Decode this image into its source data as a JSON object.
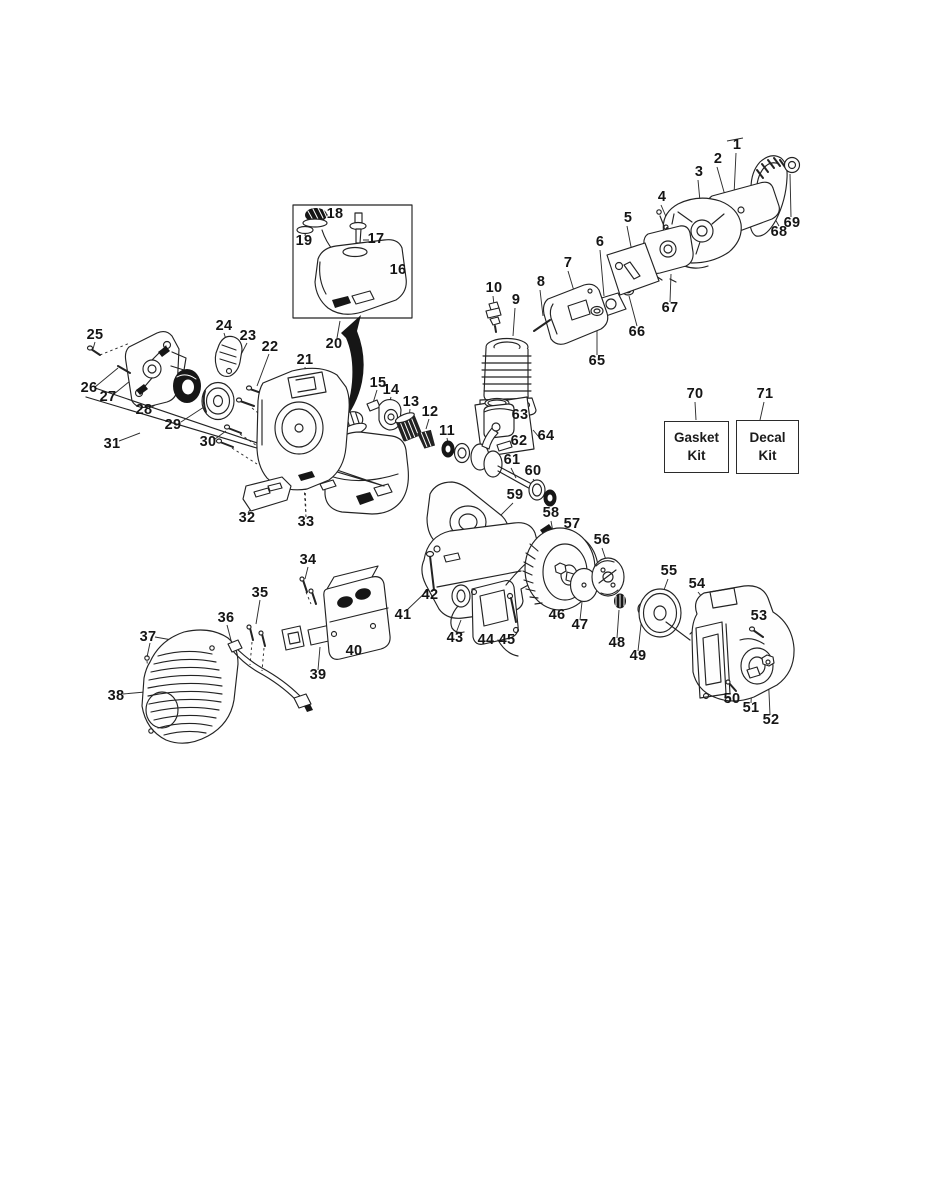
{
  "page": {
    "background": "#ffffff",
    "ink": "#232323",
    "kind": "exploded parts diagram"
  },
  "diagram": {
    "part_labels": [
      {
        "n": "1",
        "x": 737,
        "y": 146
      },
      {
        "n": "2",
        "x": 718,
        "y": 160
      },
      {
        "n": "3",
        "x": 699,
        "y": 173
      },
      {
        "n": "4",
        "x": 662,
        "y": 198
      },
      {
        "n": "5",
        "x": 628,
        "y": 219
      },
      {
        "n": "6",
        "x": 600,
        "y": 243
      },
      {
        "n": "7",
        "x": 568,
        "y": 264
      },
      {
        "n": "8",
        "x": 541,
        "y": 283
      },
      {
        "n": "9",
        "x": 516,
        "y": 301
      },
      {
        "n": "10",
        "x": 494,
        "y": 289
      },
      {
        "n": "11",
        "x": 447,
        "y": 432
      },
      {
        "n": "12",
        "x": 430,
        "y": 413
      },
      {
        "n": "13",
        "x": 411,
        "y": 403
      },
      {
        "n": "14",
        "x": 391,
        "y": 391
      },
      {
        "n": "15",
        "x": 378,
        "y": 384
      },
      {
        "n": "16",
        "x": 398,
        "y": 271
      },
      {
        "n": "17",
        "x": 376,
        "y": 240
      },
      {
        "n": "18",
        "x": 335,
        "y": 215
      },
      {
        "n": "19",
        "x": 304,
        "y": 242
      },
      {
        "n": "20",
        "x": 334,
        "y": 345
      },
      {
        "n": "21",
        "x": 305,
        "y": 361
      },
      {
        "n": "22",
        "x": 270,
        "y": 348
      },
      {
        "n": "23",
        "x": 248,
        "y": 337
      },
      {
        "n": "24",
        "x": 224,
        "y": 327
      },
      {
        "n": "25",
        "x": 95,
        "y": 336
      },
      {
        "n": "26",
        "x": 89,
        "y": 389
      },
      {
        "n": "27",
        "x": 108,
        "y": 398
      },
      {
        "n": "28",
        "x": 144,
        "y": 411
      },
      {
        "n": "29",
        "x": 173,
        "y": 426
      },
      {
        "n": "30",
        "x": 208,
        "y": 443
      },
      {
        "n": "31",
        "x": 112,
        "y": 445
      },
      {
        "n": "32",
        "x": 247,
        "y": 519
      },
      {
        "n": "33",
        "x": 306,
        "y": 523
      },
      {
        "n": "34",
        "x": 308,
        "y": 561
      },
      {
        "n": "35",
        "x": 260,
        "y": 594
      },
      {
        "n": "36",
        "x": 226,
        "y": 619
      },
      {
        "n": "37",
        "x": 148,
        "y": 638
      },
      {
        "n": "38",
        "x": 116,
        "y": 697
      },
      {
        "n": "39",
        "x": 318,
        "y": 676
      },
      {
        "n": "40",
        "x": 354,
        "y": 652
      },
      {
        "n": "41",
        "x": 403,
        "y": 616
      },
      {
        "n": "42",
        "x": 430,
        "y": 596
      },
      {
        "n": "43",
        "x": 455,
        "y": 639
      },
      {
        "n": "44",
        "x": 486,
        "y": 641
      },
      {
        "n": "45",
        "x": 507,
        "y": 641
      },
      {
        "n": "46",
        "x": 557,
        "y": 616
      },
      {
        "n": "47",
        "x": 580,
        "y": 626
      },
      {
        "n": "48",
        "x": 617,
        "y": 644
      },
      {
        "n": "49",
        "x": 638,
        "y": 657
      },
      {
        "n": "50",
        "x": 732,
        "y": 700
      },
      {
        "n": "51",
        "x": 751,
        "y": 709
      },
      {
        "n": "52",
        "x": 771,
        "y": 721
      },
      {
        "n": "53",
        "x": 759,
        "y": 617
      },
      {
        "n": "54",
        "x": 697,
        "y": 585
      },
      {
        "n": "55",
        "x": 669,
        "y": 572
      },
      {
        "n": "56",
        "x": 602,
        "y": 541
      },
      {
        "n": "57",
        "x": 572,
        "y": 525
      },
      {
        "n": "58",
        "x": 551,
        "y": 514
      },
      {
        "n": "59",
        "x": 515,
        "y": 496
      },
      {
        "n": "60",
        "x": 533,
        "y": 472
      },
      {
        "n": "61",
        "x": 512,
        "y": 461
      },
      {
        "n": "62",
        "x": 519,
        "y": 442
      },
      {
        "n": "63",
        "x": 520,
        "y": 416
      },
      {
        "n": "64",
        "x": 546,
        "y": 437
      },
      {
        "n": "65",
        "x": 597,
        "y": 362
      },
      {
        "n": "66",
        "x": 637,
        "y": 333
      },
      {
        "n": "67",
        "x": 670,
        "y": 309
      },
      {
        "n": "68",
        "x": 779,
        "y": 233
      },
      {
        "n": "69",
        "x": 792,
        "y": 224
      },
      {
        "n": "70",
        "x": 695,
        "y": 395
      },
      {
        "n": "71",
        "x": 765,
        "y": 395
      }
    ],
    "kit_boxes": [
      {
        "number": "70",
        "lines": [
          "Gasket",
          "Kit"
        ],
        "x": 664,
        "y": 421,
        "w": 63,
        "h": 50
      },
      {
        "number": "71",
        "lines": [
          "Decal",
          "Kit"
        ],
        "x": 736,
        "y": 420,
        "w": 61,
        "h": 52
      }
    ]
  }
}
